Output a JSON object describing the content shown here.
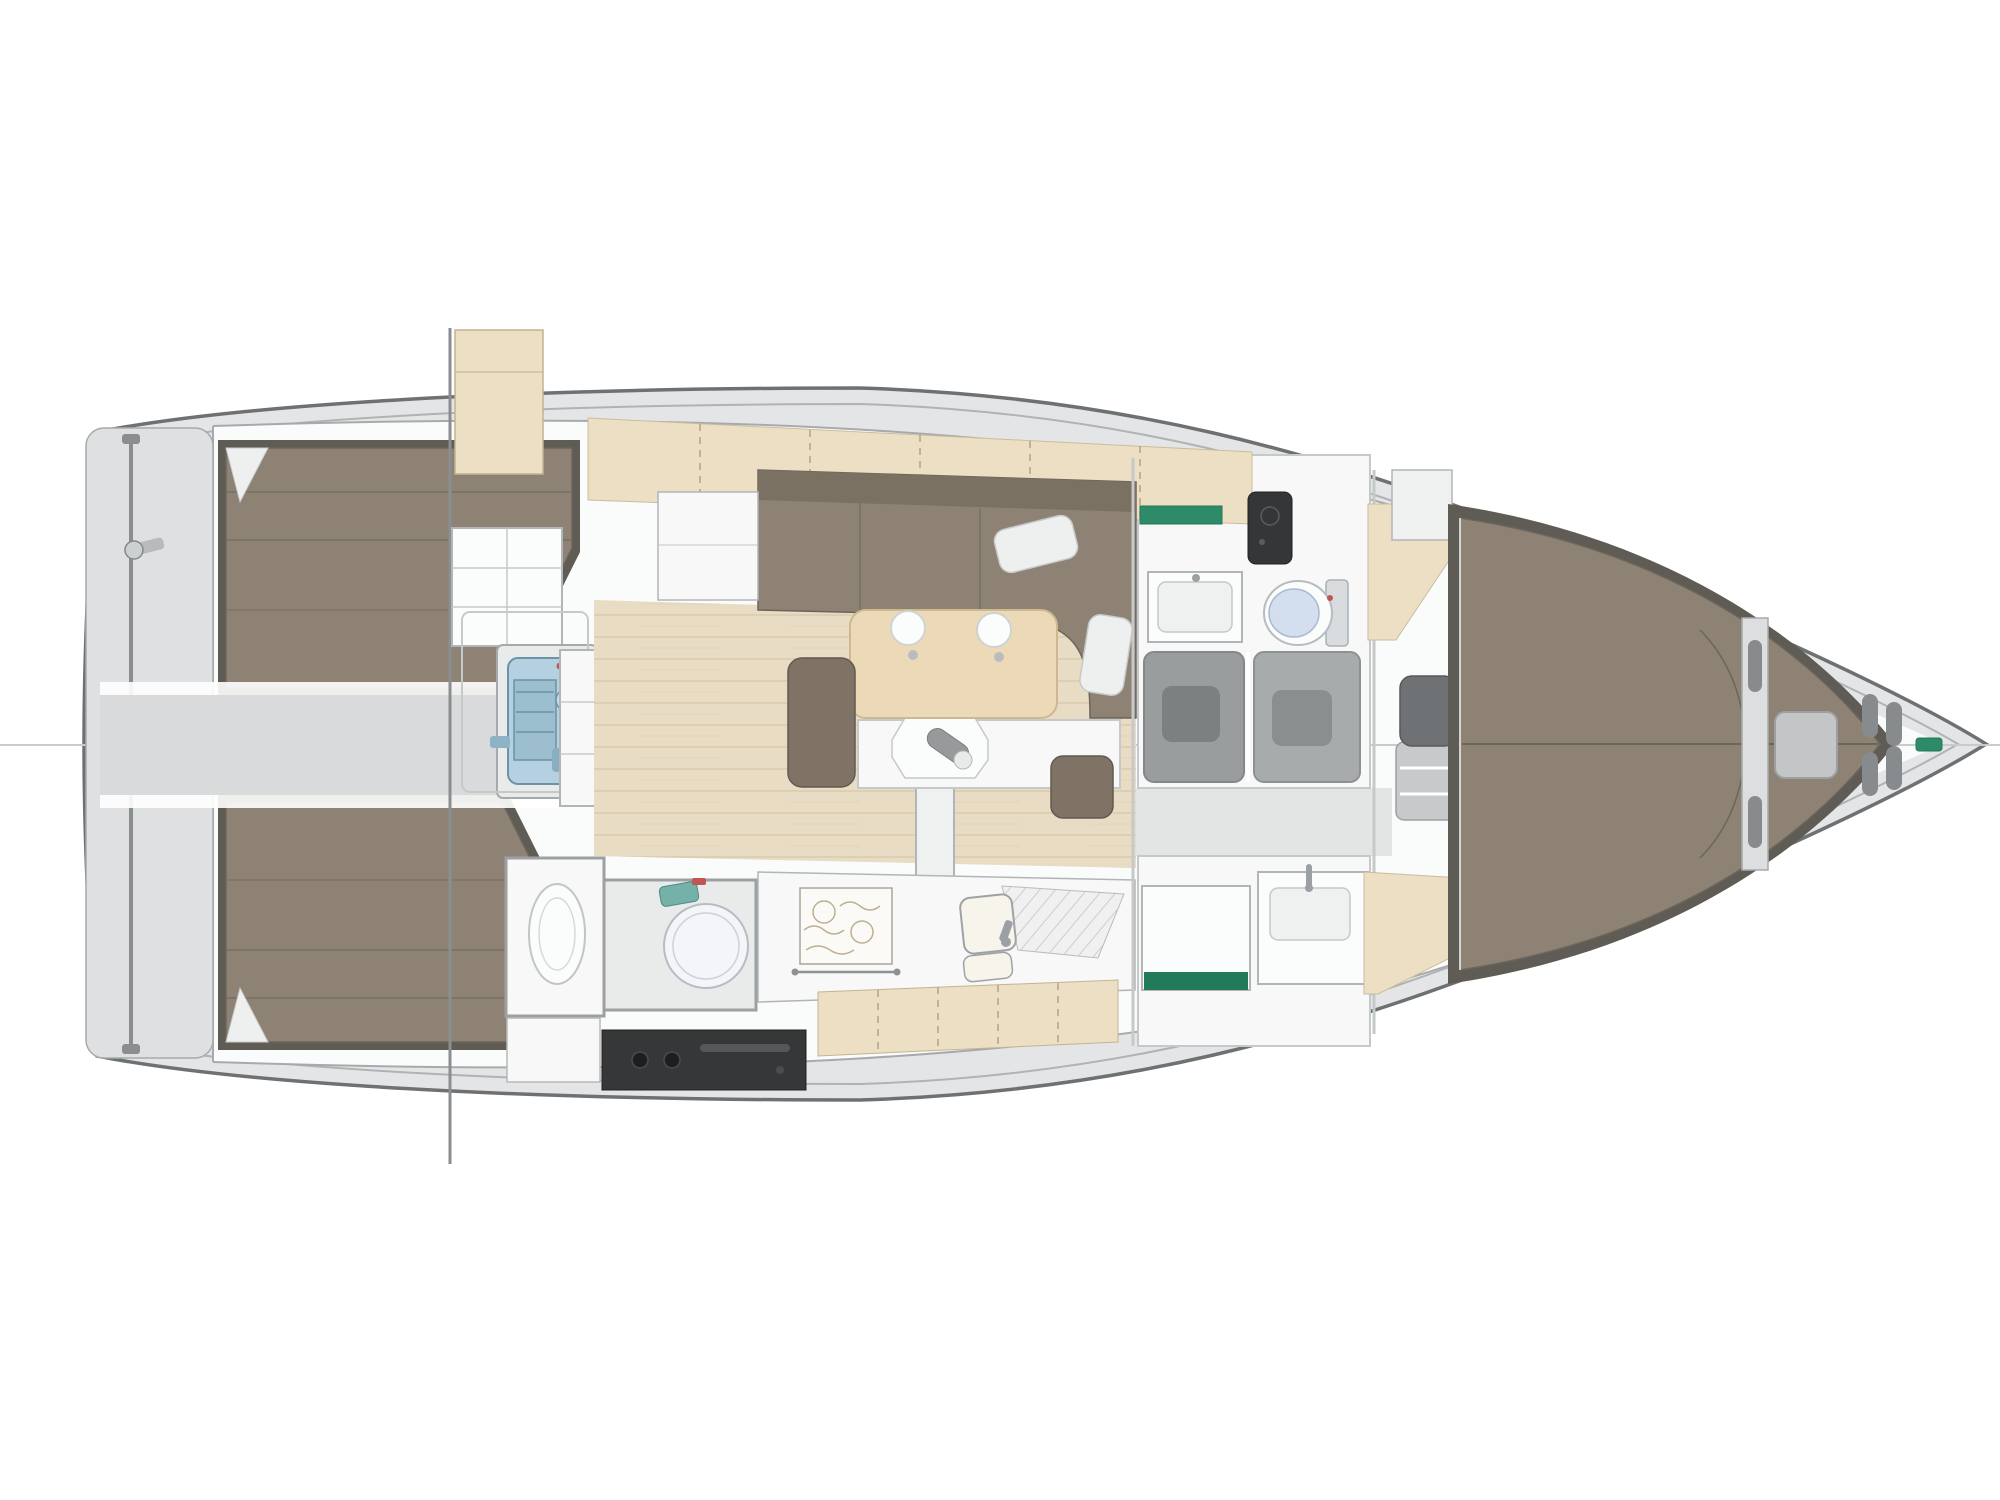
{
  "title": "Sailing yacht interior layout plan (top view)",
  "colors": {
    "deck": "#e4e5e6",
    "cabin_floor_white": "#fafbfb",
    "hull_line": "#6e7173",
    "inner_hull_line": "#b0b3b5",
    "transom": "#dfe0e1",
    "rail_gray": "#8b8e90",
    "centerline": "#c8cacb",
    "berth_brown": "#8d8274",
    "berth_dark_trim": "#5f5c55",
    "berth_seam": "#6c655a",
    "settee_back": "#7b7163",
    "bench_brown": "#7e7365",
    "pillow_white": "#eef0f0",
    "wood_floor": "#e8ddc4",
    "wood_plank_line": "#d5c6a6",
    "locker_wood": "#ecdfc3",
    "locker_seam": "#b3a284",
    "table_wood": "#ecd9b7",
    "engine_blue": "#b5d0e0",
    "engine_blue_dark": "#9dbecf",
    "engine_detail": "#6b92a7",
    "corridor_gray": "#d8dadb",
    "walkway_gray": "#e3e4e4",
    "appliance_black": "#353738",
    "stove_pattern": "#bdb091",
    "shower_gray": "#9a9d9d",
    "shower_gray_light": "#a8abab",
    "shower_seat_gray": "#7d8081",
    "seat_dark_gray": "#6f7274",
    "stool_gray": "#c7c9ca",
    "toilet_lid_blue": "#d3dfee",
    "heater_pump_teal": "#74b1a9",
    "accent_red": "#c0564f",
    "accent_green": "#2e8b68",
    "accent_green_dark": "#237a58",
    "vanity_black": "#343637",
    "fitting_gray": "#888b8d",
    "bottle_gray": "#97999b"
  },
  "parts": {
    "plan": "Sailing yacht interior layout plan (top view)",
    "hull": "Hull outline",
    "coachroof": "Coachroof / cabin boundary",
    "centerline": "Centerline",
    "transom": "Transom swim platform",
    "ladder": "Swim ladder rail",
    "rail_fitting": "Transom rail fitting",
    "port_aft_berth": "Port aft cabin double berth",
    "stbd_aft_berth": "Starboard aft cabin double berth",
    "pillow": "Berth cushion",
    "corridor": "Aft corridor / technical space",
    "engine_room": "Engine compartment",
    "engine": "Engine",
    "garage": "Companionway garage",
    "traveler": "Mainsheet traveler track",
    "hatch": "Companionway hatch panels",
    "steps": "Companionway steps",
    "cockpit_ghost": "Cockpit structure (ghosted)",
    "aft_head": "Aft heads compartment",
    "aft_head_basin": "Aft heads bowl",
    "water_heater": "Water heater / round tank",
    "heater_pump": "Pump unit",
    "galley": "Galley worktop",
    "stove": "Gimbaled stove with pot holders",
    "galley_sink": "Galley sink",
    "drainer": "Draining rack",
    "galley_lockers": "Galley locker fronts",
    "oven": "Oven / cooker front",
    "cabinet_front": "Galley cabinet front",
    "salon_floor": "Saloon sole (wood planks)",
    "salon_lockers": "Port side lockers",
    "settee": "Saloon U-settee",
    "settee_cabinet": "Settee end cabinet",
    "table": "Saloon table (wood top)",
    "cup_holder": "Recessed cup holder",
    "table_leaf": "Lowered table leaf",
    "tray": "Serving tray",
    "bottle": "Bottle",
    "pedestal": "Table pedestal",
    "bench_aft": "Upholstered bench (aft)",
    "bench_fwd": "Upholstered bench (forward)",
    "head_fwd": "Forward heads compartment",
    "head_sink": "Heads washbasin console",
    "green_shelf": "Green shelf",
    "vanity": "Dark vanity unit",
    "toilet": "Toilet",
    "shower_port": "Shower stall (inboard)",
    "shower_stbd": "Shower stall (outboard)",
    "shower_seat": "Shower seat",
    "stbd_head": "Starboard heads / shower room",
    "stbd_cabinet": "Cabinet with green base",
    "stbd_sink": "Washbasin console",
    "walkway": "Passage to forward cabin",
    "wood_wedge": "Forward cabin wood sole",
    "fwd_cabin": "Forward cabin",
    "berth_base": "V-berth base",
    "fwd_berth": "Forward V-berth",
    "fwd_seat": "Forward cabin seat",
    "step_stool": "Step stool",
    "bulkhead": "Chain locker bulkhead",
    "windlass": "Windlass / locker lid",
    "hawse": "Hawse slots",
    "bow_fitting": "Bow fitting (green)"
  }
}
